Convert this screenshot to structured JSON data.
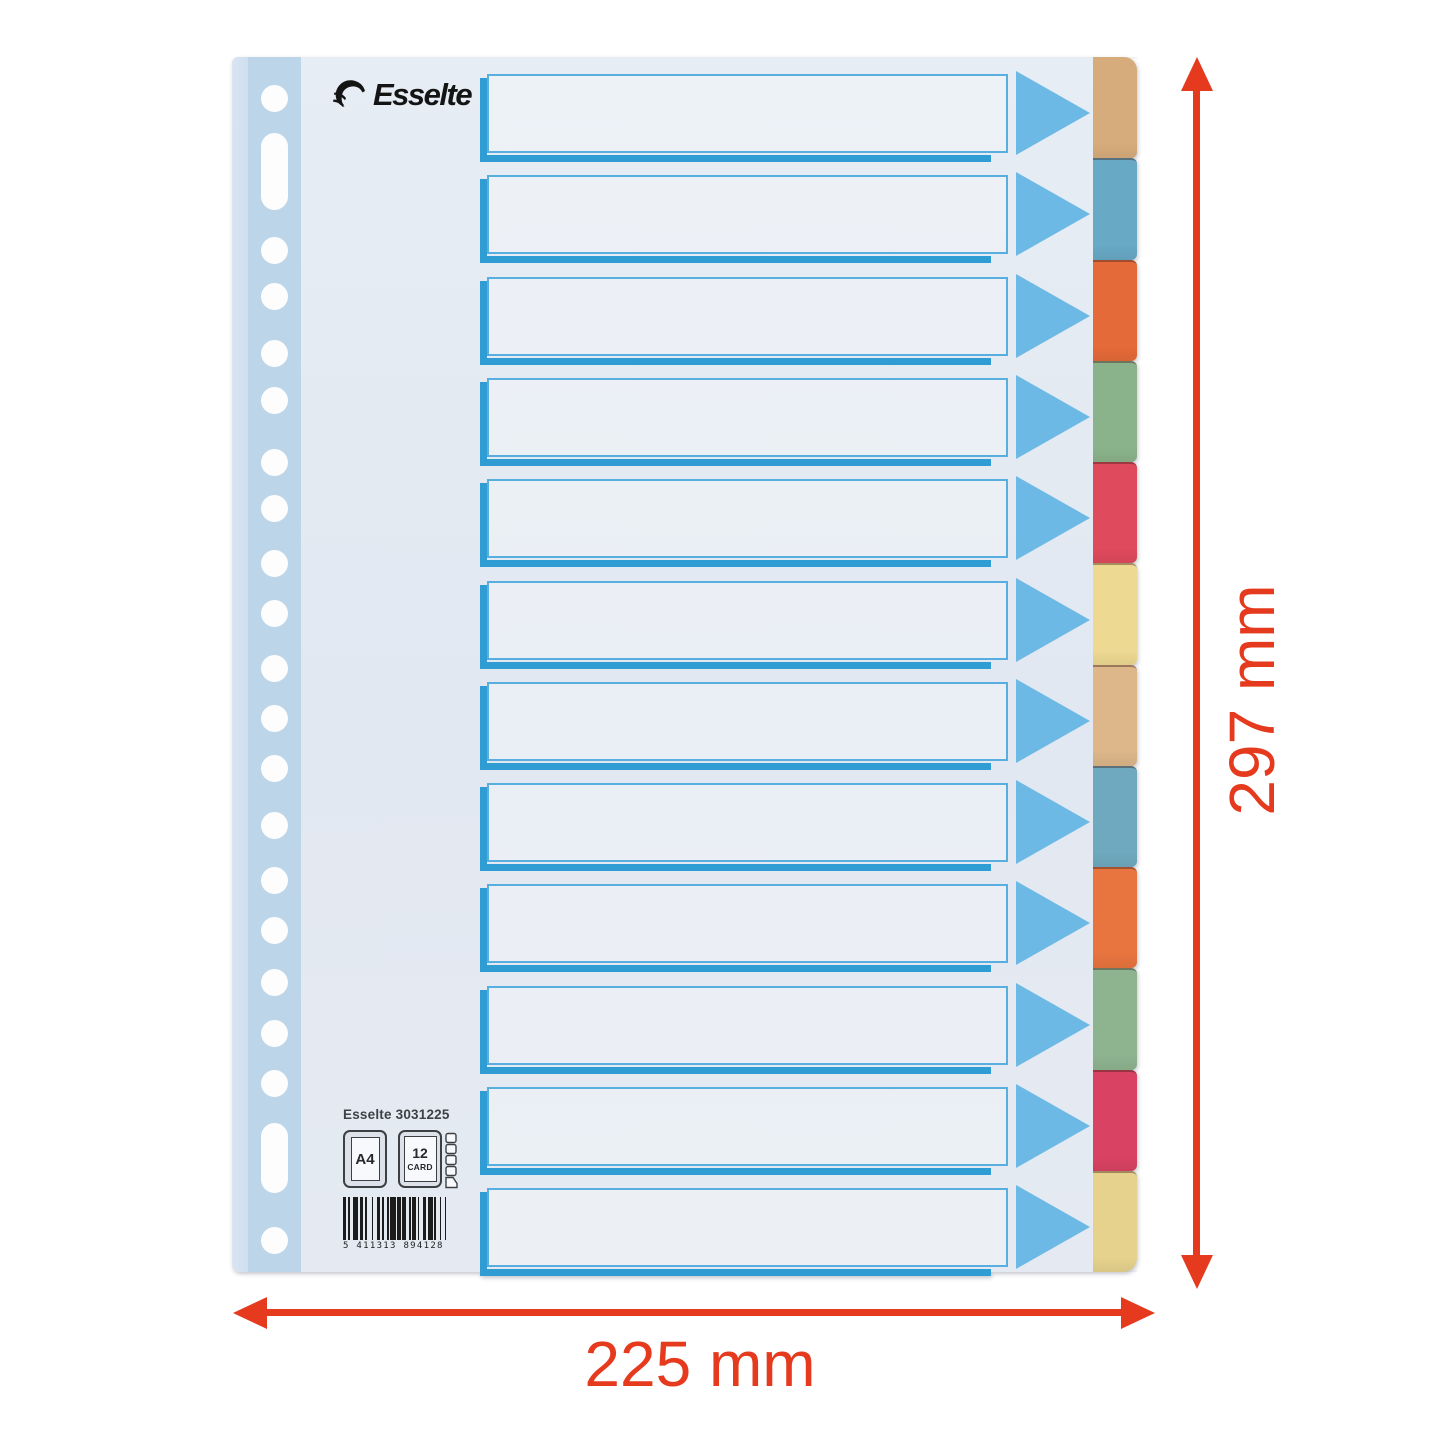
{
  "brand": {
    "logo_text": "Esselte"
  },
  "annotations": {
    "height_label": "297 mm",
    "width_label": "225 mm",
    "color": "#e63a1e"
  },
  "imprint": {
    "product_line": "Esselte 3031225",
    "format_badge": "A4",
    "count_badge": "12",
    "material_badge": "CARD",
    "barcode_digits": "5 411313 894128"
  },
  "divider": {
    "row_count": 12,
    "label_box_border_color": "#58aede",
    "label_box_accent_color": "#2f9cd4",
    "arrow_color": "#6db9e6",
    "sheet_color": "#e4eaf2",
    "punch_strip_color": "#bcd5e8",
    "tabs": [
      {
        "name": "tan",
        "color": "#d7ac7c"
      },
      {
        "name": "blue",
        "color": "#68a9c6"
      },
      {
        "name": "orange",
        "color": "#e56a39"
      },
      {
        "name": "green",
        "color": "#8bb38b"
      },
      {
        "name": "red",
        "color": "#e04a5d"
      },
      {
        "name": "yellow",
        "color": "#eed992"
      },
      {
        "name": "tan",
        "color": "#ddb68a"
      },
      {
        "name": "blue",
        "color": "#6fa9bf"
      },
      {
        "name": "orange",
        "color": "#e8743f"
      },
      {
        "name": "green",
        "color": "#8eb38f"
      },
      {
        "name": "red",
        "color": "#d94263"
      },
      {
        "name": "yellow",
        "color": "#e6d28d"
      }
    ]
  },
  "punching": {
    "hole_diameter": 27,
    "round_hole_centers_y": [
      41,
      193,
      239,
      296,
      343,
      405,
      451,
      506,
      556,
      611,
      661,
      711,
      768,
      823,
      873,
      925,
      976,
      1026,
      1183
    ],
    "slots_y": [
      [
        76,
        153
      ],
      [
        1066,
        1136
      ]
    ]
  }
}
